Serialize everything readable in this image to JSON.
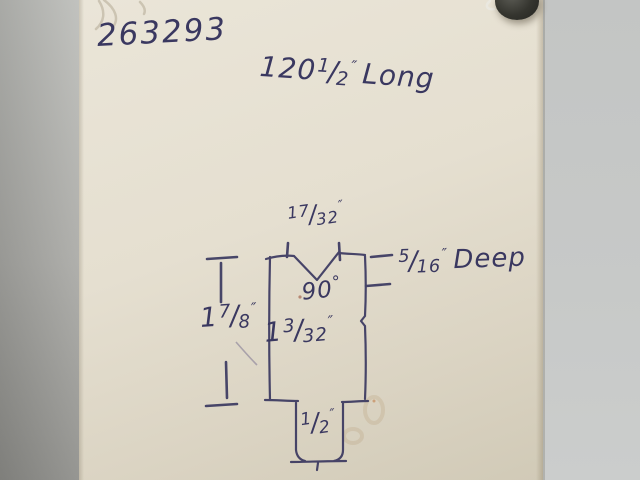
{
  "glyphs": {
    "fraction_slash": "/",
    "degree": "°"
  },
  "sketch": {
    "part_number": "263293",
    "length_note": {
      "whole": "120",
      "num": "1",
      "den": "2",
      "unit": "″",
      "word": "Long"
    },
    "v_opening": {
      "num": "17",
      "den": "32",
      "unit": "″"
    },
    "v_angle": {
      "value": "90",
      "unit": "°"
    },
    "v_depth": {
      "num": "5",
      "den": "16",
      "unit": "″",
      "word": "Deep"
    },
    "overall_height": {
      "whole": "1",
      "num": "7",
      "den": "8",
      "unit": "″"
    },
    "body_height": {
      "whole": "1",
      "num": "3",
      "den": "32",
      "unit": "″"
    },
    "tongue_width": {
      "num": "1",
      "den": "2",
      "unit": "″"
    }
  },
  "colors": {
    "ink": "#3a3860",
    "pencil": "#9b93a3",
    "paper": "#e5dfd0",
    "wall_left": "#9f9f9b",
    "wall_right": "#c6c8c7",
    "magnet": "#33332f"
  }
}
